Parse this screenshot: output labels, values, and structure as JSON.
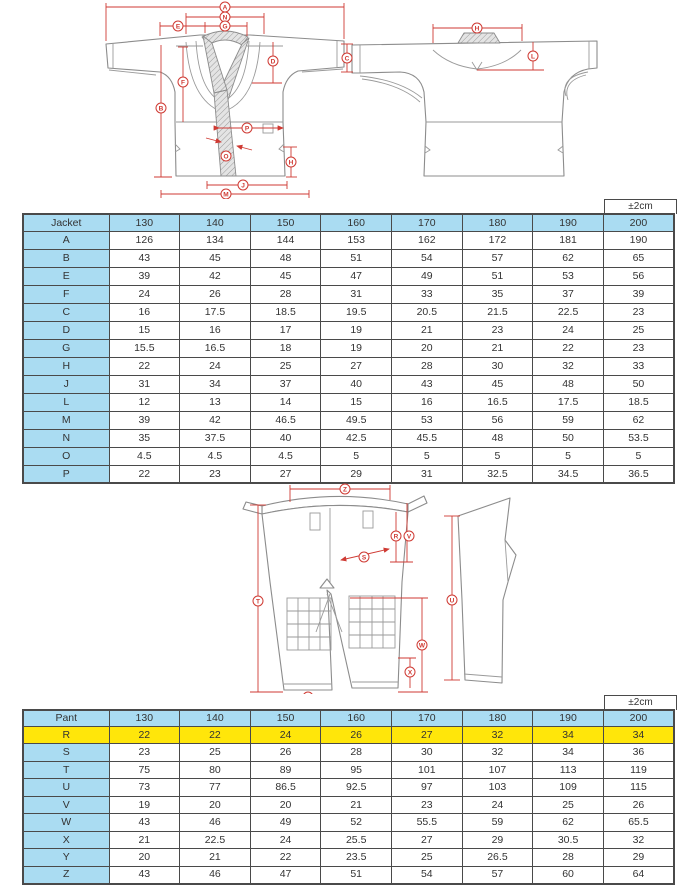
{
  "tolerance_label": "±2cm",
  "colors": {
    "accent_red": "#cf3a33",
    "table_header_blue": "#aadcf2",
    "highlight_yellow": "#ffe60a",
    "line_gray": "#8c8c8c"
  },
  "diagrams": {
    "jacket_front_markers": [
      "A",
      "N",
      "E",
      "G",
      "D",
      "F",
      "B",
      "P",
      "O",
      "H",
      "J",
      "M"
    ],
    "jacket_back_markers": [
      "H",
      "C",
      "L"
    ],
    "pants_front_markers": [
      "Z",
      "R",
      "V",
      "S",
      "T",
      "W",
      "X",
      "Y"
    ],
    "pants_side_markers": [
      "U"
    ]
  },
  "chart_data": [
    {
      "type": "table",
      "title": "Jacket",
      "tolerance": "±2cm",
      "columns": [
        "130",
        "140",
        "150",
        "160",
        "170",
        "180",
        "190",
        "200"
      ],
      "rows": [
        {
          "label": "A",
          "values": [
            126,
            134,
            144,
            153,
            162,
            172,
            181,
            190
          ]
        },
        {
          "label": "B",
          "values": [
            43,
            45,
            48,
            51,
            54,
            57,
            62,
            65
          ]
        },
        {
          "label": "E",
          "values": [
            39,
            42,
            45,
            47,
            49,
            51,
            53,
            56
          ]
        },
        {
          "label": "F",
          "values": [
            24,
            26,
            28,
            31,
            33,
            35,
            37,
            39
          ]
        },
        {
          "label": "C",
          "values": [
            16,
            17.5,
            18.5,
            19.5,
            20.5,
            21.5,
            22.5,
            23
          ]
        },
        {
          "label": "D",
          "values": [
            15,
            16,
            17,
            19,
            21,
            23,
            24,
            25
          ]
        },
        {
          "label": "G",
          "values": [
            15.5,
            16.5,
            18,
            19,
            20,
            21,
            22,
            23
          ]
        },
        {
          "label": "H",
          "values": [
            22,
            24,
            25,
            27,
            28,
            30,
            32,
            33
          ]
        },
        {
          "label": "J",
          "values": [
            31,
            34,
            37,
            40,
            43,
            45,
            48,
            50
          ]
        },
        {
          "label": "L",
          "values": [
            12,
            13,
            14,
            15,
            16,
            16.5,
            17.5,
            18.5
          ]
        },
        {
          "label": "M",
          "values": [
            39,
            42,
            46.5,
            49.5,
            53,
            56,
            59,
            62
          ]
        },
        {
          "label": "N",
          "values": [
            35,
            37.5,
            40,
            42.5,
            45.5,
            48,
            50,
            53.5
          ]
        },
        {
          "label": "O",
          "values": [
            4.5,
            4.5,
            4.5,
            5,
            5,
            5,
            5,
            5
          ]
        },
        {
          "label": "P",
          "values": [
            22,
            23,
            27,
            29,
            31,
            32.5,
            34.5,
            36.5
          ]
        }
      ]
    },
    {
      "type": "table",
      "title": "Pant",
      "tolerance": "±2cm",
      "columns": [
        "130",
        "140",
        "150",
        "160",
        "170",
        "180",
        "190",
        "200"
      ],
      "rows": [
        {
          "label": "R",
          "values": [
            22,
            22,
            24,
            26,
            27,
            32,
            34,
            34
          ],
          "highlight": true
        },
        {
          "label": "S",
          "values": [
            23,
            25,
            26,
            28,
            30,
            32,
            34,
            36
          ]
        },
        {
          "label": "T",
          "values": [
            75,
            80,
            89,
            95,
            101,
            107,
            113,
            119
          ]
        },
        {
          "label": "U",
          "values": [
            73,
            77,
            86.5,
            92.5,
            97,
            103,
            109,
            115
          ]
        },
        {
          "label": "V",
          "values": [
            19,
            20,
            20,
            21,
            23,
            24,
            25,
            26
          ]
        },
        {
          "label": "W",
          "values": [
            43,
            46,
            49,
            52,
            55.5,
            59,
            62,
            65.5
          ]
        },
        {
          "label": "X",
          "values": [
            21,
            22.5,
            24,
            25.5,
            27,
            29,
            30.5,
            32
          ]
        },
        {
          "label": "Y",
          "values": [
            20,
            21,
            22,
            23.5,
            25,
            26.5,
            28,
            29
          ]
        },
        {
          "label": "Z",
          "values": [
            43,
            46,
            47,
            51,
            54,
            57,
            60,
            64
          ]
        }
      ]
    }
  ]
}
